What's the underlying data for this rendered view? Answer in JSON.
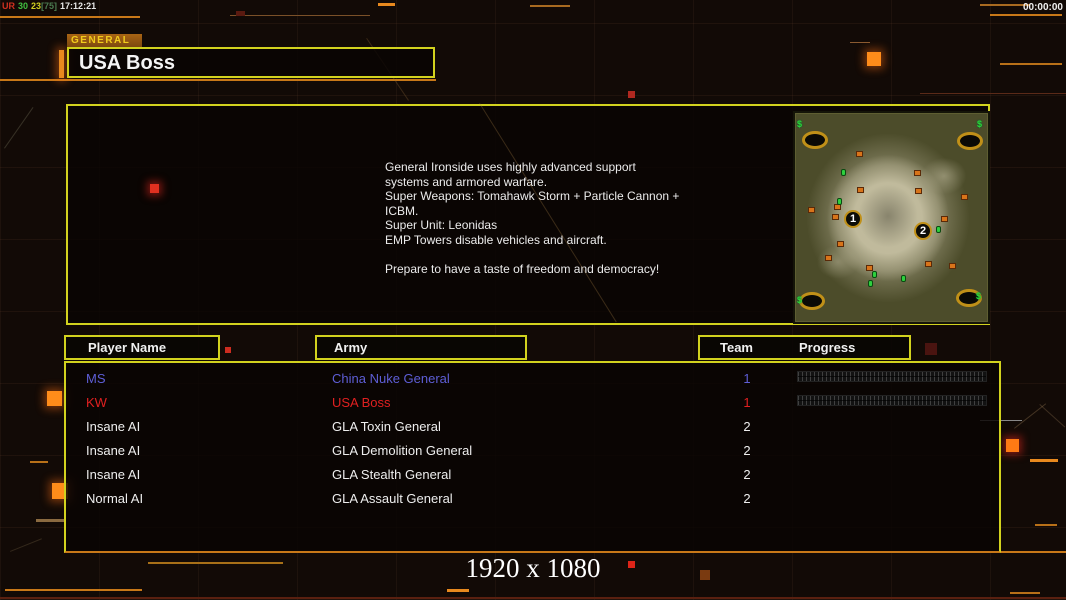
{
  "status_bar": {
    "fps_counter": {
      "label_ur": "UR",
      "value_a": "30",
      "value_b": "23",
      "value_c": "[75]",
      "clock": "17:12:21"
    },
    "match_timer": "00:00:00"
  },
  "header": {
    "tab_label": "GENERAL",
    "title": "USA Boss"
  },
  "briefing": {
    "text": "General Ironside uses highly advanced support\n systems and armored warfare.\nSuper Weapons: Tomahawk Storm + Particle Cannon +\n ICBM.\nSuper Unit: Leonidas\nEMP Towers disable vehicles and aircraft.\n\nPrepare to have a taste of freedom and democracy!"
  },
  "minimap": {
    "markers": [
      {
        "label": "1",
        "x": 57,
        "y": 105
      },
      {
        "label": "2",
        "x": 127,
        "y": 117
      }
    ],
    "resources": [
      {
        "t": "m",
        "x": 1,
        "y": 6
      },
      {
        "t": "m",
        "x": 181,
        "y": 6
      },
      {
        "t": "m",
        "x": 1,
        "y": 182
      },
      {
        "t": "m",
        "x": 180,
        "y": 178
      },
      {
        "t": "o",
        "x": 60,
        "y": 37
      },
      {
        "t": "o",
        "x": 118,
        "y": 56
      },
      {
        "t": "o",
        "x": 61,
        "y": 73
      },
      {
        "t": "o",
        "x": 119,
        "y": 74
      },
      {
        "t": "o",
        "x": 165,
        "y": 80
      },
      {
        "t": "o",
        "x": 38,
        "y": 90
      },
      {
        "t": "o",
        "x": 12,
        "y": 93
      },
      {
        "t": "o",
        "x": 36,
        "y": 100
      },
      {
        "t": "o",
        "x": 145,
        "y": 102
      },
      {
        "t": "o",
        "x": 41,
        "y": 127
      },
      {
        "t": "o",
        "x": 29,
        "y": 141
      },
      {
        "t": "o",
        "x": 70,
        "y": 151
      },
      {
        "t": "o",
        "x": 129,
        "y": 147
      },
      {
        "t": "o",
        "x": 153,
        "y": 149
      },
      {
        "t": "g",
        "x": 45,
        "y": 55
      },
      {
        "t": "g",
        "x": 41,
        "y": 84
      },
      {
        "t": "g",
        "x": 140,
        "y": 112
      },
      {
        "t": "g",
        "x": 76,
        "y": 157
      },
      {
        "t": "g",
        "x": 72,
        "y": 166
      },
      {
        "t": "g",
        "x": 105,
        "y": 161
      }
    ],
    "money_symbol": "$"
  },
  "player_table": {
    "headers": {
      "player_name": "Player Name",
      "army": "Army",
      "team": "Team",
      "progress": "Progress"
    },
    "rows": [
      {
        "player": "MS",
        "army": "China Nuke General",
        "team": "1",
        "color": "#5e5ed6",
        "has_progress": true
      },
      {
        "player": "KW",
        "army": "USA Boss",
        "team": "1",
        "color": "#e02020",
        "has_progress": true
      },
      {
        "player": "Insane AI",
        "army": "GLA Toxin General",
        "team": "2",
        "color": "#eeeeee",
        "has_progress": false
      },
      {
        "player": "Insane AI",
        "army": "GLA Demolition General",
        "team": "2",
        "color": "#eeeeee",
        "has_progress": false
      },
      {
        "player": "Insane AI",
        "army": "GLA Stealth General",
        "team": "2",
        "color": "#eeeeee",
        "has_progress": false
      },
      {
        "player": "Normal AI",
        "army": "GLA Assault General",
        "team": "2",
        "color": "#eeeeee",
        "has_progress": false
      }
    ]
  },
  "footer": {
    "resolution_label": "1920 x 1080"
  },
  "colors": {
    "accent_border": "#d2d21e",
    "accent_orange": "#c87818",
    "bright_orange": "#ff8c1a",
    "status_red": "#d03020",
    "status_green": "#40c040",
    "status_yellow": "#d0d020",
    "status_dim": "#4a7a50",
    "player_blue": "#5e5ed6",
    "player_red": "#e02020",
    "text_white": "#efefef"
  }
}
